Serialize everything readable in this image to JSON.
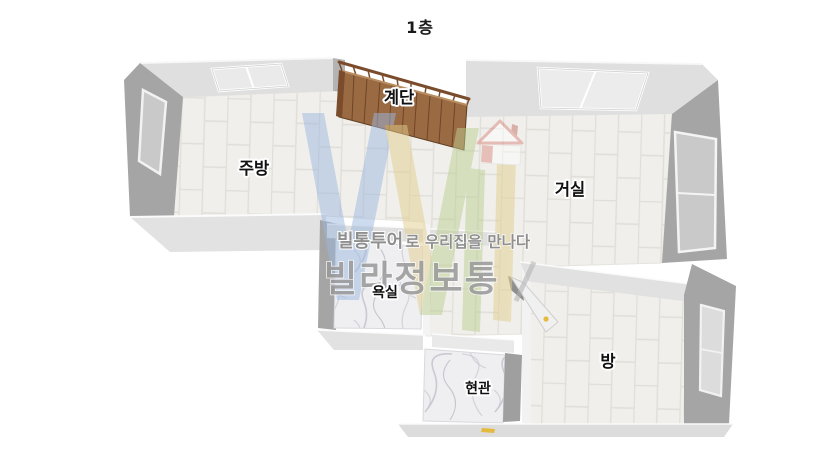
{
  "title": "1층",
  "rooms": {
    "stairs": {
      "label": "계단"
    },
    "kitchen": {
      "label": "주방"
    },
    "living_room": {
      "label": "거실"
    },
    "bathroom": {
      "label": "욕실"
    },
    "entrance": {
      "label": "현관"
    },
    "bedroom": {
      "label": "방"
    }
  },
  "watermark": {
    "slogan_brand": "빌통투어",
    "slogan_rest": "로 우리집을 만나다",
    "brand": "빌라정보통"
  },
  "colors": {
    "background": "#ffffff",
    "wall_top": "#dfdfdf",
    "wall_side": "#a5a5a5",
    "floor_tile": "#f0efeb",
    "tile_line": "#e0ded8",
    "marble_base": "#efeff2",
    "stairs_wood": "#9a6a43",
    "stairs_wood_dark": "#6f4526",
    "watermark_blue": "#9db8e0",
    "watermark_yellow": "#e3cf8e",
    "watermark_green": "#bccf90",
    "watermark_red": "#d98880",
    "watermark_text": "#8f8f8f",
    "brand_text": "#999999",
    "label_text": "#111111",
    "door_handle": "#e3b93e"
  }
}
